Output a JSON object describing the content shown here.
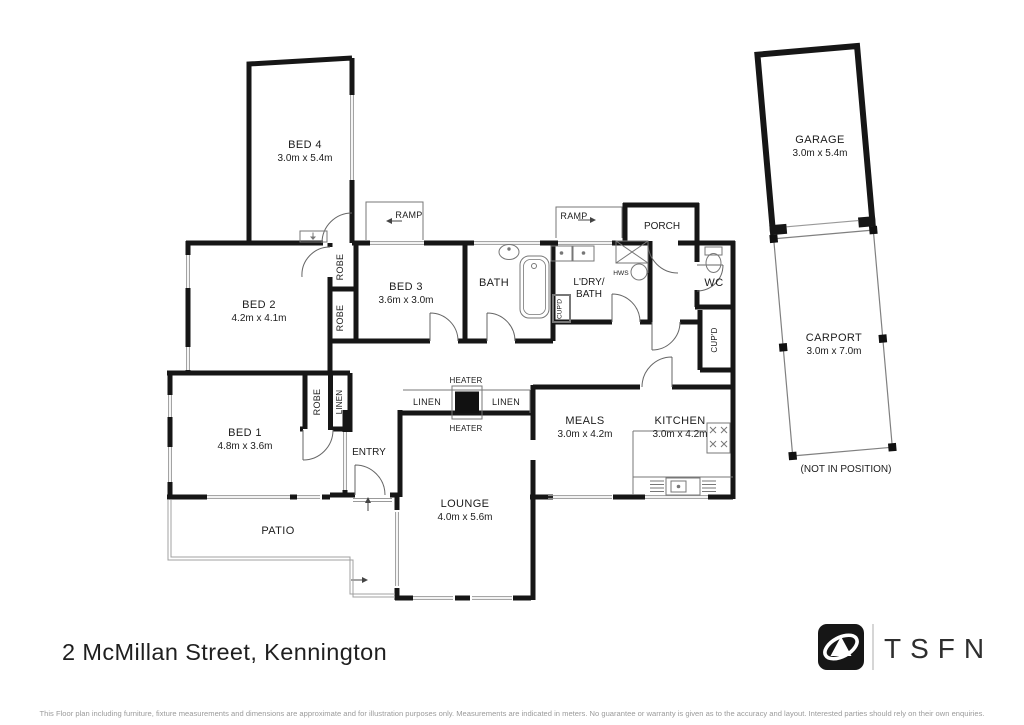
{
  "plan": {
    "rooms": {
      "bed4": {
        "name": "BED 4",
        "dims": "3.0m x 5.4m"
      },
      "bed2": {
        "name": "BED 2",
        "dims": "4.2m x 4.1m"
      },
      "bed3": {
        "name": "BED 3",
        "dims": "3.6m x 3.0m"
      },
      "bed1": {
        "name": "BED 1",
        "dims": "4.8m x 3.6m"
      },
      "bath": {
        "name": "BATH"
      },
      "ldry": {
        "line1": "L'DRY/",
        "line2": "BATH"
      },
      "porch": {
        "name": "PORCH"
      },
      "wc": {
        "name": "WC"
      },
      "entry": {
        "name": "ENTRY"
      },
      "meals": {
        "name": "MEALS",
        "dims": "3.0m x 4.2m"
      },
      "kitchen": {
        "name": "KITCHEN",
        "dims": "3.0m x 4.2m"
      },
      "lounge": {
        "name": "LOUNGE",
        "dims": "4.0m x 5.6m"
      },
      "patio": {
        "name": "PATIO"
      },
      "garage": {
        "name": "GARAGE",
        "dims": "3.0m x 5.4m"
      },
      "carport": {
        "name": "CARPORT",
        "dims": "3.0m x 7.0m",
        "note": "(NOT IN POSITION)"
      }
    },
    "fixtures": {
      "ramp": "RAMP",
      "robe": "ROBE",
      "linen": "LINEN",
      "heater": "HEATER",
      "cupd": "CUP'D",
      "hws": "HWS"
    },
    "colors": {
      "wall": "#161616",
      "thin_line": "#777777",
      "window_line": "#999999",
      "text": "#1c1c1c",
      "disclaimer_text": "#9b9b9b"
    }
  },
  "footer": {
    "address": "2 McMillan Street, Kennington",
    "logo_text": "TSFN",
    "disclaimer": "This Floor plan including furniture, fixture measurements and dimensions are approximate and for illustration purposes only. Measurements are indicated in meters. No guarantee or warranty is given as to the accuracy and layout. Interested parties should rely on their own enquiries."
  }
}
